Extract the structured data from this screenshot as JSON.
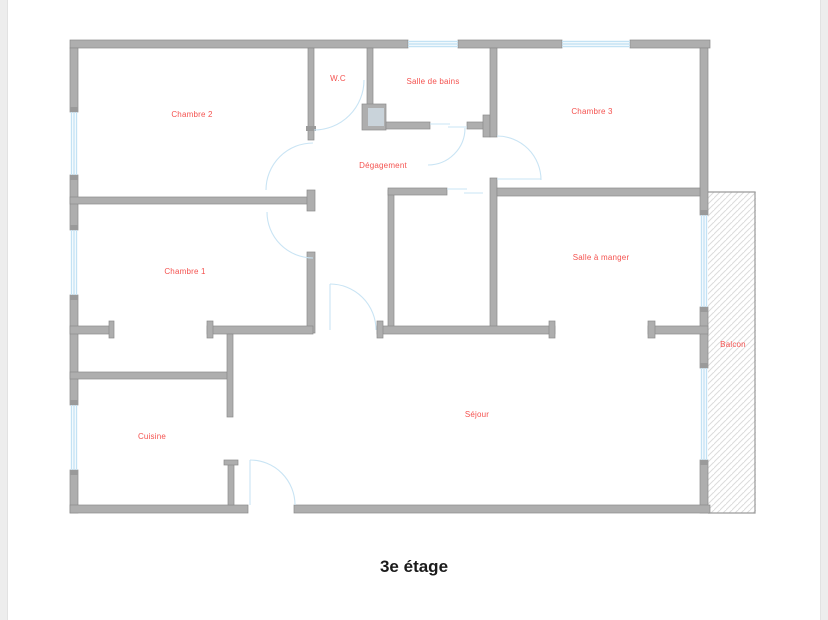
{
  "page": {
    "title": "3e étage",
    "background": "#ffffff"
  },
  "plan": {
    "colors": {
      "wall": "#aeaeae",
      "wall_edge": "#8a8a8a",
      "window": "#c3e2f4",
      "door_arc": "#c9e4f4",
      "label": "#f4524f",
      "hatch": "#dcdcdc"
    },
    "rooms": [
      {
        "id": "chambre-2",
        "label": "Chambre 2"
      },
      {
        "id": "wc",
        "label": "W.C"
      },
      {
        "id": "salle-de-bains",
        "label": "Salle de bains"
      },
      {
        "id": "chambre-3",
        "label": "Chambre 3"
      },
      {
        "id": "degagement",
        "label": "Dégagement"
      },
      {
        "id": "chambre-1",
        "label": "Chambre 1"
      },
      {
        "id": "salle-a-manger",
        "label": "Salle à manger"
      },
      {
        "id": "balcon",
        "label": "Balcon"
      },
      {
        "id": "cuisine",
        "label": "Cuisine"
      },
      {
        "id": "sejour",
        "label": "Séjour"
      }
    ]
  }
}
